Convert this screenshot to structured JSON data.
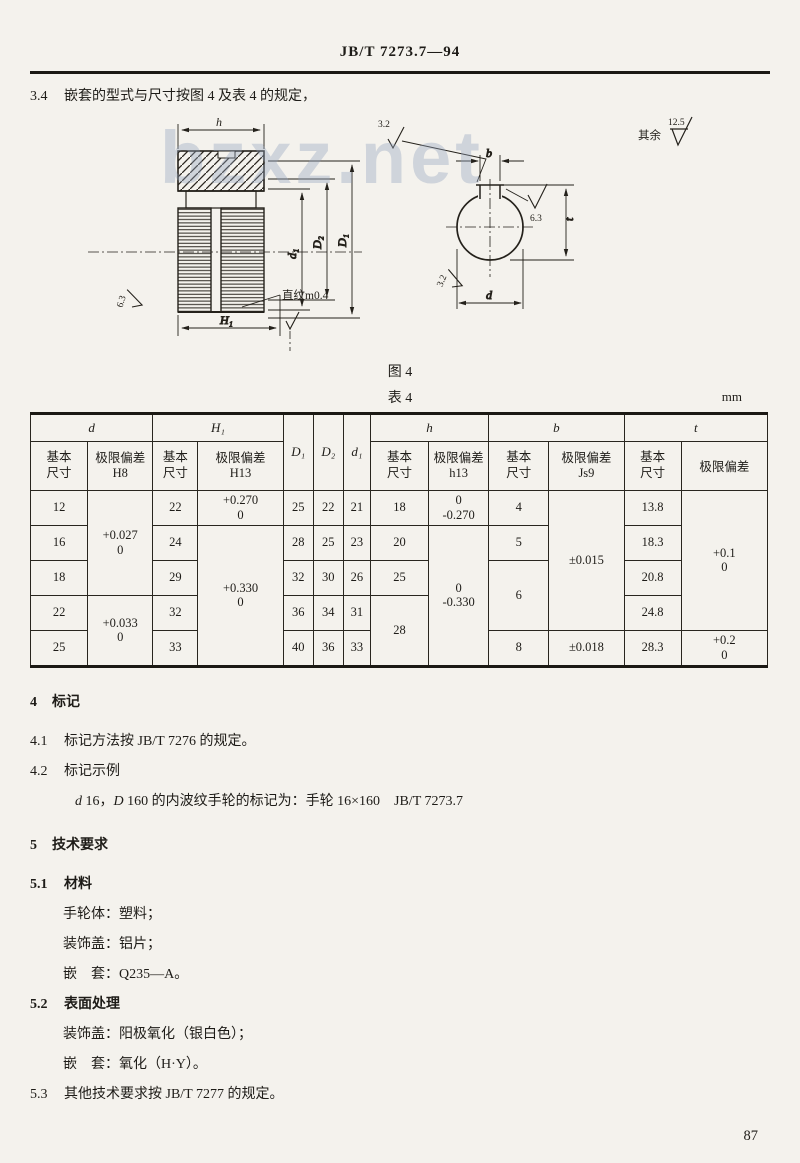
{
  "doc": {
    "header": "JB/T 7273.7—94",
    "page_number": "87",
    "sec34": {
      "num": "3.4",
      "text": "嵌套的型式与尺寸按图 4 及表 4 的规定，"
    },
    "fig_caption": "图 4",
    "table_caption": "表 4",
    "unit": "mm",
    "sec4_num": "4",
    "sec4_title": "标记",
    "sec41": {
      "num": "4.1",
      "text": "标记方法按 JB/T 7276 的规定。"
    },
    "sec42": {
      "num": "4.2",
      "text": "标记示例"
    },
    "example": {
      "d_it": "d",
      "d_val": " 16，",
      "D_it": "D",
      "rest": " 160 的内波纹手轮的标记为：手轮 16×160　JB/T 7273.7"
    },
    "sec5_num": "5",
    "sec5_title": "技术要求",
    "sec51": {
      "num": "5.1",
      "title": "材料"
    },
    "mat1": "手轮体：塑料；",
    "mat2": "装饰盖：铝片；",
    "mat3": "嵌　套：Q235—A。",
    "sec52": {
      "num": "5.2",
      "title": "表面处理"
    },
    "surf1": "装饰盖：阳极氧化（银白色）；",
    "surf2": "嵌　套：氧化（H·Y）。",
    "sec53": {
      "num": "5.3",
      "text": "其他技术要求按 JB/T 7277 的规定。"
    }
  },
  "figure": {
    "watermark": "bzxz.net",
    "labels": {
      "dim_h": "h",
      "dim_H1": "H₁",
      "dim_d1": "d₁",
      "dim_D2": "D₂",
      "dim_D1": "D₁",
      "knurl_note": "直纹m0.4",
      "rough_left": "6.3",
      "rough_top": "3.2",
      "dim_b": "b",
      "rough_keyway": "6.3",
      "rough_bore": "3.2",
      "dim_t": "t",
      "dim_d": "d",
      "other_label": "其余",
      "other_val": "12.5"
    }
  },
  "table4": {
    "head": {
      "g_d": "d",
      "g_H1": "H₁",
      "c_D1": "D₁",
      "c_D2": "D₂",
      "c_d1": "d₁",
      "g_h": "h",
      "g_b": "b",
      "g_t": "t",
      "basic": "基本尺寸",
      "dev": "极限偏差",
      "cls_H8": "H8",
      "cls_H13": "H13",
      "cls_h13": "h13",
      "cls_Js9": "Js9"
    },
    "body": {
      "d": [
        "12",
        "16",
        "18",
        "22",
        "25"
      ],
      "d_dev": [
        {
          "top": "+0.027",
          "bot": "0"
        },
        {
          "top": "+0.033",
          "bot": "0"
        }
      ],
      "H1": [
        "22",
        "24",
        "29",
        "32",
        "33"
      ],
      "H1_dev": [
        {
          "top": "+0.270",
          "bot": "0"
        },
        {
          "top": "+0.330",
          "bot": "0"
        }
      ],
      "D1": [
        "25",
        "28",
        "32",
        "36",
        "40"
      ],
      "D2": [
        "22",
        "25",
        "30",
        "34",
        "36"
      ],
      "d1": [
        "21",
        "23",
        "26",
        "31",
        "33"
      ],
      "h": [
        "18",
        "20",
        "25",
        "28"
      ],
      "h_dev": [
        {
          "top": "0",
          "bot": "-0.270"
        },
        {
          "top": "0",
          "bot": "-0.330"
        }
      ],
      "b": [
        "4",
        "5",
        "6",
        "8"
      ],
      "b_dev": [
        "±0.015",
        "±0.018"
      ],
      "t": [
        "13.8",
        "18.3",
        "20.8",
        "24.8",
        "28.3"
      ],
      "t_dev": [
        {
          "top": "+0.1",
          "bot": "0"
        },
        {
          "top": "+0.2",
          "bot": "0"
        }
      ]
    }
  }
}
